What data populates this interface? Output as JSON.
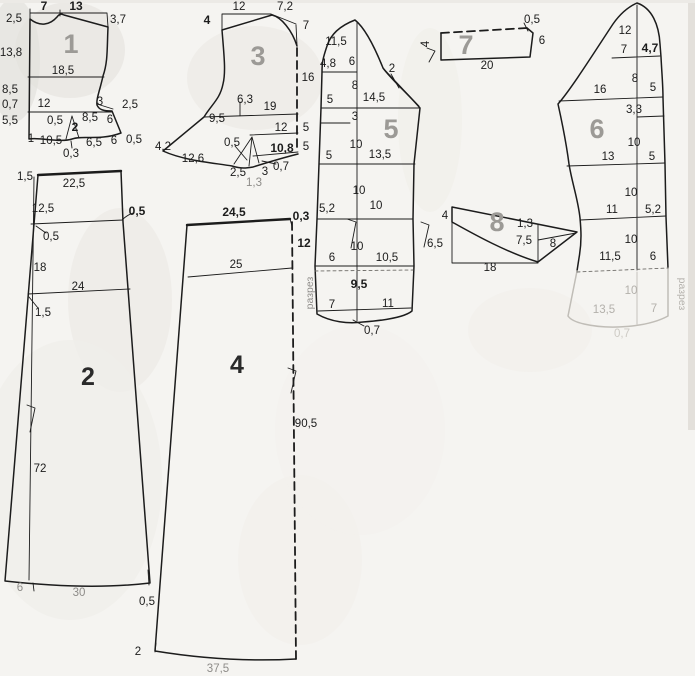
{
  "colors": {
    "paper": "#f5f4f1",
    "ink": "#1c1c1c",
    "piece_number_gray": "#9c9a96",
    "piece_number_dark": "#2a2a2a",
    "faint": "#b3b0ab"
  },
  "pieces": [
    {
      "number": "1",
      "number_style": "gray",
      "number_x": 71,
      "number_y": 53,
      "labels": [
        {
          "t": "7",
          "x": 44,
          "y": 10,
          "cls": "b"
        },
        {
          "t": "13",
          "x": 76,
          "y": 10,
          "cls": "b"
        },
        {
          "t": "2,5",
          "x": 14,
          "y": 22
        },
        {
          "t": "3,7",
          "x": 118,
          "y": 23
        },
        {
          "t": "13,8",
          "x": 11,
          "y": 56
        },
        {
          "t": "18,5",
          "x": 63,
          "y": 74
        },
        {
          "t": "8,5",
          "x": 10,
          "y": 93
        },
        {
          "t": "0,7",
          "x": 10,
          "y": 108
        },
        {
          "t": "12",
          "x": 44,
          "y": 107
        },
        {
          "t": "3",
          "x": 100,
          "y": 105
        },
        {
          "t": "2,5",
          "x": 130,
          "y": 108
        },
        {
          "t": "5,5",
          "x": 10,
          "y": 124
        },
        {
          "t": "0,5",
          "x": 55,
          "y": 124
        },
        {
          "t": "8,5",
          "x": 90,
          "y": 121
        },
        {
          "t": "6",
          "x": 110,
          "y": 123
        },
        {
          "t": "2",
          "x": 75,
          "y": 131,
          "cls": "b"
        },
        {
          "t": "1",
          "x": 31,
          "y": 142
        },
        {
          "t": "10,5",
          "x": 51,
          "y": 144
        },
        {
          "t": "0,3",
          "x": 71,
          "y": 157
        },
        {
          "t": "6,5",
          "x": 94,
          "y": 146
        },
        {
          "t": "6",
          "x": 114,
          "y": 144
        },
        {
          "t": "0,5",
          "x": 134,
          "y": 143
        }
      ]
    },
    {
      "number": "2",
      "number_style": "dark",
      "number_x": 88,
      "number_y": 385,
      "labels": [
        {
          "t": "1,5",
          "x": 25,
          "y": 180
        },
        {
          "t": "22,5",
          "x": 74,
          "y": 187
        },
        {
          "t": "12,5",
          "x": 43,
          "y": 212
        },
        {
          "t": "0,5",
          "x": 137,
          "y": 215,
          "cls": "b"
        },
        {
          "t": "0,5",
          "x": 51,
          "y": 240
        },
        {
          "t": "18",
          "x": 40,
          "y": 271
        },
        {
          "t": "24",
          "x": 78,
          "y": 290
        },
        {
          "t": "1,5",
          "x": 43,
          "y": 316
        },
        {
          "t": "72",
          "x": 40,
          "y": 472
        },
        {
          "t": "6",
          "x": 20,
          "y": 591,
          "cls": "g"
        },
        {
          "t": "30",
          "x": 79,
          "y": 596,
          "cls": "g"
        },
        {
          "t": "0,5",
          "x": 147,
          "y": 605
        }
      ]
    },
    {
      "number": "3",
      "number_style": "gray",
      "number_x": 258,
      "number_y": 65,
      "labels": [
        {
          "t": "12",
          "x": 239,
          "y": 10
        },
        {
          "t": "7,2",
          "x": 285,
          "y": 10
        },
        {
          "t": "4",
          "x": 207,
          "y": 24,
          "cls": "b"
        },
        {
          "t": "7",
          "x": 306,
          "y": 29
        },
        {
          "t": "16",
          "x": 308,
          "y": 81
        },
        {
          "t": "6,3",
          "x": 245,
          "y": 103
        },
        {
          "t": "19",
          "x": 270,
          "y": 110
        },
        {
          "t": "9,5",
          "x": 217,
          "y": 122
        },
        {
          "t": "12",
          "x": 281,
          "y": 131
        },
        {
          "t": "5",
          "x": 306,
          "y": 131
        },
        {
          "t": "0,5",
          "x": 232,
          "y": 146
        },
        {
          "t": "10,8",
          "x": 282,
          "y": 152,
          "cls": "b"
        },
        {
          "t": "5",
          "x": 306,
          "y": 150
        },
        {
          "t": "4,2",
          "x": 163,
          "y": 150
        },
        {
          "t": "12,6",
          "x": 193,
          "y": 162
        },
        {
          "t": "2,5",
          "x": 238,
          "y": 176
        },
        {
          "t": "1,3",
          "x": 254,
          "y": 186,
          "cls": "g"
        },
        {
          "t": "3",
          "x": 265,
          "y": 175
        },
        {
          "t": "0,7",
          "x": 281,
          "y": 170
        }
      ]
    },
    {
      "number": "4",
      "number_style": "dark",
      "number_x": 237,
      "number_y": 373,
      "labels": [
        {
          "t": "24,5",
          "x": 234,
          "y": 216,
          "cls": "b"
        },
        {
          "t": "0,3",
          "x": 301,
          "y": 220,
          "cls": "b"
        },
        {
          "t": "12",
          "x": 304,
          "y": 247,
          "cls": "b"
        },
        {
          "t": "25",
          "x": 236,
          "y": 268
        },
        {
          "t": "90,5",
          "x": 306,
          "y": 427
        },
        {
          "t": "2",
          "x": 138,
          "y": 655
        },
        {
          "t": "37,5",
          "x": 218,
          "y": 672,
          "cls": "g"
        }
      ]
    },
    {
      "number": "5",
      "number_style": "gray",
      "number_x": 391,
      "number_y": 138,
      "labels": [
        {
          "t": "11,5",
          "x": 336,
          "y": 45
        },
        {
          "t": "4,8",
          "x": 328,
          "y": 67
        },
        {
          "t": "6",
          "x": 352,
          "y": 65
        },
        {
          "t": "2",
          "x": 392,
          "y": 72
        },
        {
          "t": "8",
          "x": 355,
          "y": 89
        },
        {
          "t": "5",
          "x": 330,
          "y": 103
        },
        {
          "t": "14,5",
          "x": 374,
          "y": 101
        },
        {
          "t": "3",
          "x": 355,
          "y": 120
        },
        {
          "t": "10",
          "x": 356,
          "y": 148
        },
        {
          "t": "5",
          "x": 329,
          "y": 159
        },
        {
          "t": "13,5",
          "x": 380,
          "y": 158
        },
        {
          "t": "10",
          "x": 359,
          "y": 194
        },
        {
          "t": "5,2",
          "x": 327,
          "y": 212
        },
        {
          "t": "10",
          "x": 376,
          "y": 209
        },
        {
          "t": "10",
          "x": 357,
          "y": 250
        },
        {
          "t": "6",
          "x": 332,
          "y": 261
        },
        {
          "t": "10,5",
          "x": 387,
          "y": 261
        },
        {
          "t": "9,5",
          "x": 359,
          "y": 288,
          "cls": "b"
        },
        {
          "t": "7",
          "x": 332,
          "y": 308
        },
        {
          "t": "11",
          "x": 388,
          "y": 307
        },
        {
          "t": "0,7",
          "x": 372,
          "y": 334
        },
        {
          "t": "разрез",
          "x": 313,
          "y": 293,
          "cls": "sm g",
          "r": -90,
          "n": "cut-mark-label"
        }
      ]
    },
    {
      "number": "6",
      "number_style": "gray",
      "number_x": 597,
      "number_y": 138,
      "labels": [
        {
          "t": "12",
          "x": 625,
          "y": 34
        },
        {
          "t": "7",
          "x": 624,
          "y": 53
        },
        {
          "t": "4,7",
          "x": 650,
          "y": 52,
          "cls": "b"
        },
        {
          "t": "8",
          "x": 635,
          "y": 82
        },
        {
          "t": "16",
          "x": 600,
          "y": 93
        },
        {
          "t": "5",
          "x": 653,
          "y": 91
        },
        {
          "t": "3,3",
          "x": 634,
          "y": 113
        },
        {
          "t": "10",
          "x": 634,
          "y": 146
        },
        {
          "t": "13",
          "x": 608,
          "y": 160
        },
        {
          "t": "5",
          "x": 652,
          "y": 160
        },
        {
          "t": "10",
          "x": 631,
          "y": 196
        },
        {
          "t": "11",
          "x": 612,
          "y": 213
        },
        {
          "t": "5,2",
          "x": 653,
          "y": 213
        },
        {
          "t": "10",
          "x": 631,
          "y": 243
        },
        {
          "t": "11,5",
          "x": 610,
          "y": 260
        },
        {
          "t": "6",
          "x": 653,
          "y": 260
        },
        {
          "t": "10",
          "x": 631,
          "y": 294,
          "cls": "f"
        },
        {
          "t": "13,5",
          "x": 604,
          "y": 313,
          "cls": "f"
        },
        {
          "t": "7",
          "x": 654,
          "y": 312,
          "cls": "f"
        },
        {
          "t": "0,7",
          "x": 622,
          "y": 337,
          "cls": "vf"
        },
        {
          "t": "разрез",
          "x": 679,
          "y": 294,
          "cls": "sm f",
          "r": 90,
          "n": "cut-mark-label"
        }
      ]
    },
    {
      "number": "7",
      "number_style": "gray",
      "number_x": 466,
      "number_y": 54,
      "labels": [
        {
          "t": "0,5",
          "x": 532,
          "y": 23
        },
        {
          "t": "6",
          "x": 542,
          "y": 44
        },
        {
          "t": "20",
          "x": 487,
          "y": 69
        },
        {
          "t": "4",
          "x": 429,
          "y": 44,
          "r": -90
        }
      ]
    },
    {
      "number": "8",
      "number_style": "gray",
      "number_x": 497,
      "number_y": 231,
      "labels": [
        {
          "t": "4",
          "x": 445,
          "y": 219
        },
        {
          "t": "1,3",
          "x": 525,
          "y": 227
        },
        {
          "t": "7,5",
          "x": 524,
          "y": 244
        },
        {
          "t": "8",
          "x": 553,
          "y": 247
        },
        {
          "t": "6,5",
          "x": 435,
          "y": 247
        },
        {
          "t": "18",
          "x": 490,
          "y": 271
        }
      ]
    }
  ]
}
